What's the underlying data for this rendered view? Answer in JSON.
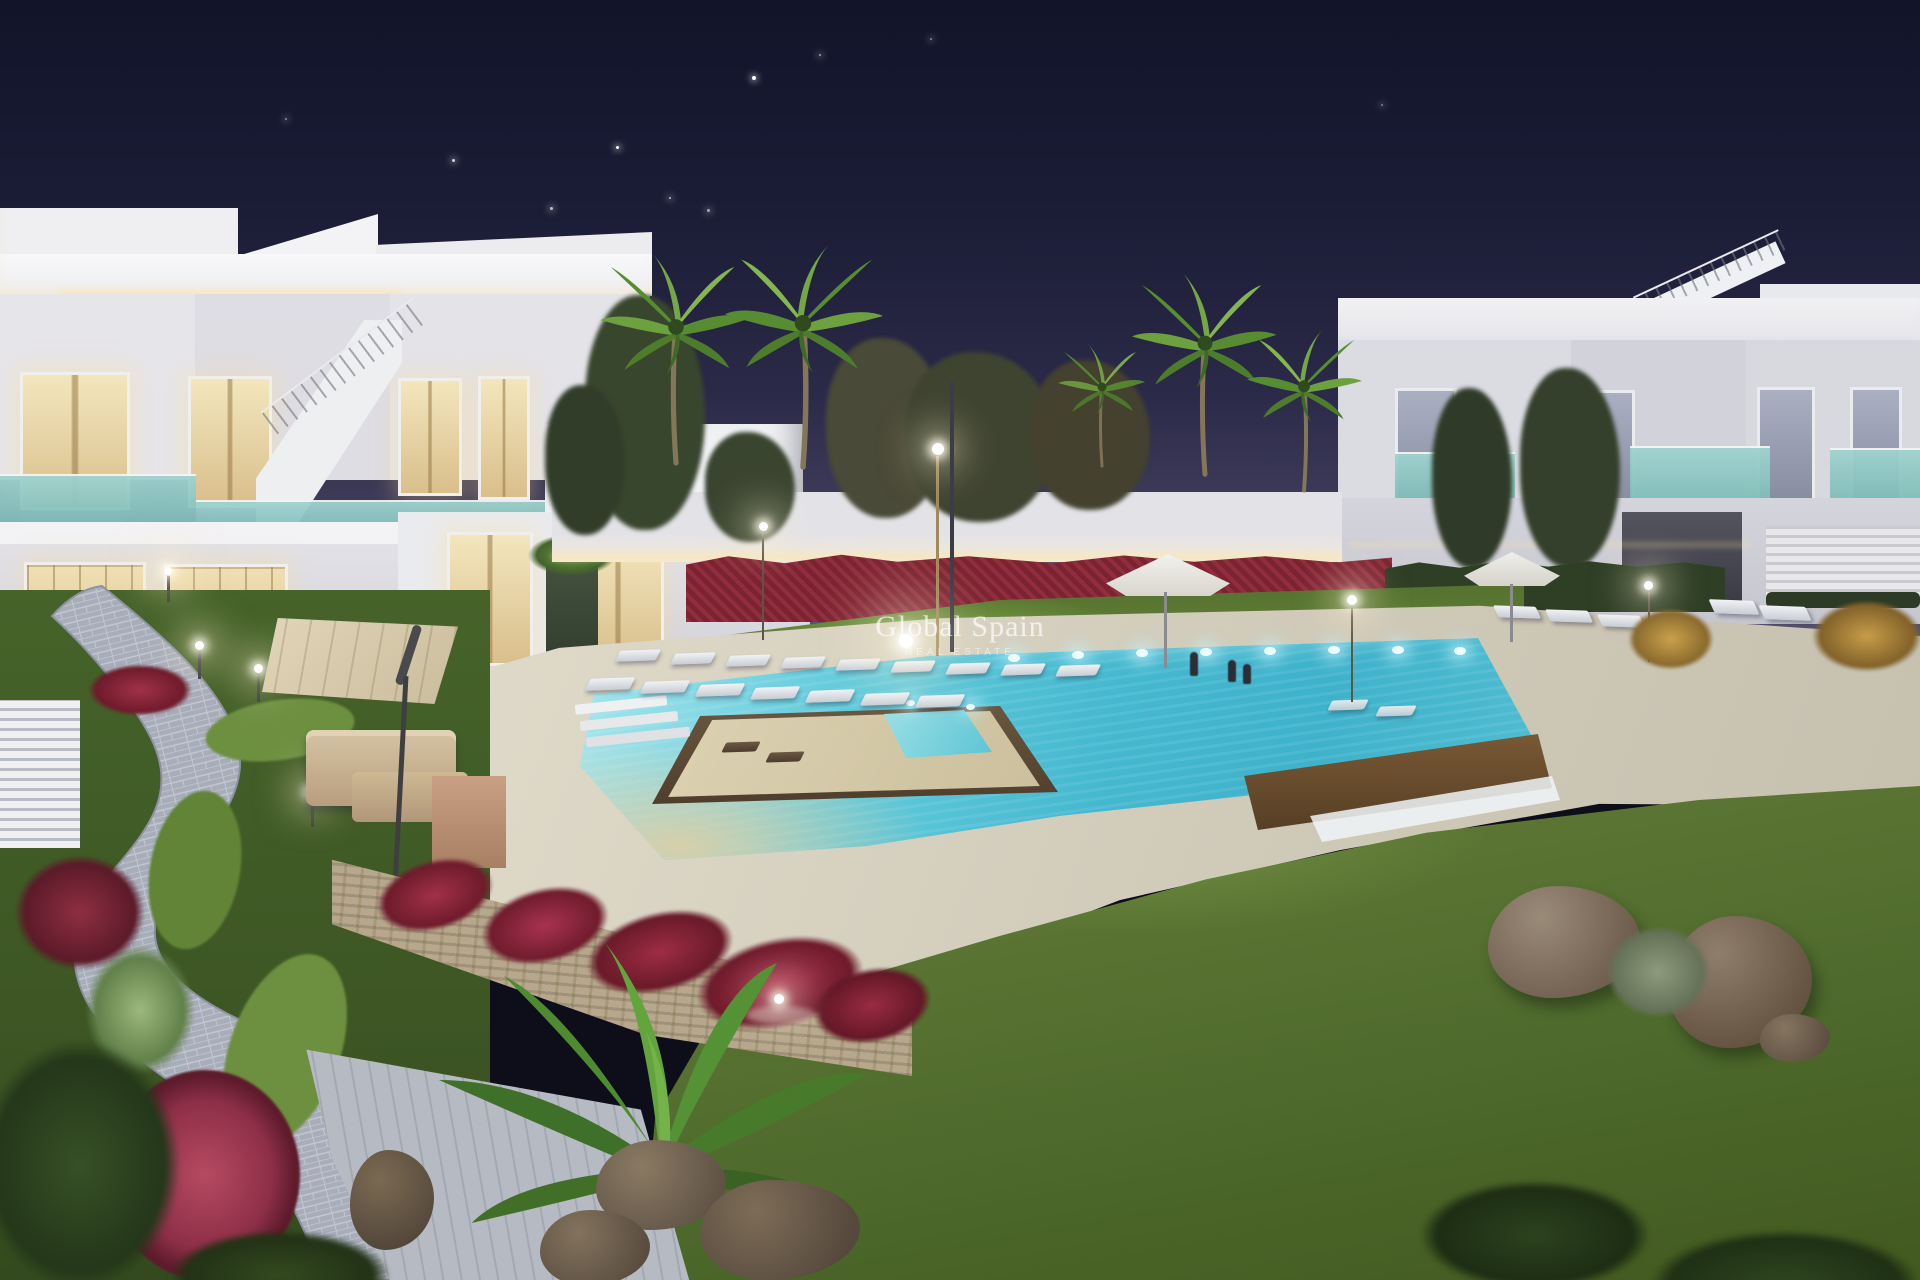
{
  "watermark": {
    "brand": "Global Spain",
    "tagline": "REAL ESTATE"
  },
  "palette": {
    "sky_top": "#12142a",
    "sky_horizon": "#5d5878",
    "building_white": "#e9e8ec",
    "window_glow": "#e6d3a0",
    "glass_teal": "#9fd3cf",
    "pool_water": "#53c2d6",
    "pool_shallow": "#d8cfae",
    "lawn_green": "#5f7f36",
    "flower_red": "#8e2438",
    "deck_beige": "#d9d3c5",
    "path_gray": "#a7abb6",
    "stone_wall": "#b3a58c"
  }
}
